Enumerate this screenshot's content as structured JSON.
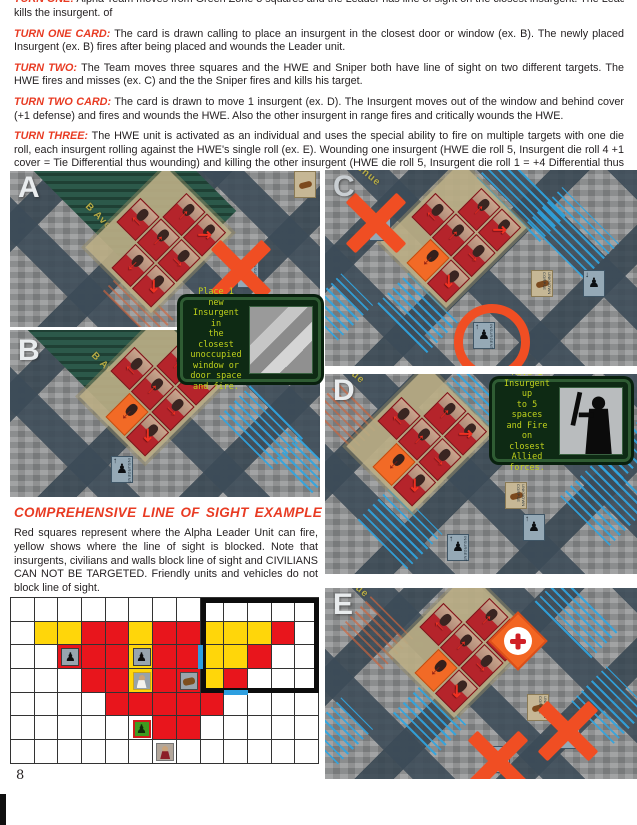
{
  "page": {
    "number": "8"
  },
  "intro": {
    "clipped_label": "TURN ONE:",
    "clipped_text": "Alpha Team moves from Green Zone 3 squares and the Leader has line of sight on the closest insurgent. The Leader fires and",
    "tail": "kills the insurgent. of"
  },
  "paragraphs": [
    {
      "label": "TURN ONE CARD:",
      "text": "The card is drawn calling to place an insurgent in the closest door or window (ex. B). The newly placed Insurgent (ex. B) fires after being placed and wounds the Leader unit."
    },
    {
      "label": "TURN TWO:",
      "text": "The Team moves three squares and the HWE and Sniper both have line of sight on two different targets. The HWE fires and misses (ex. C) and the the Sniper fires and kills his target."
    },
    {
      "label": "TURN TWO CARD:",
      "text": "The card is drawn to move 1 insurgent (ex. D). The Insurgent moves out of the window and behind cover (+1 defense) and fires and wounds the HWE. Also the other insurgent in range fires and critically wounds the HWE."
    },
    {
      "label": "TURN THREE:",
      "text": "The HWE unit is activated as an individual and uses the special ability to fire on multiple targets with one die roll, each insurgent rolling against the HWE's single roll (ex. E). Wounding one insurgent (HWE die roll 5, Insurgent die roll 4 +1 cover = Tie Differential thus wounding) and killing the other insurgent (HWE die roll 5, Insurgent die roll 1 = +4 Differential thus killing)."
    }
  ],
  "los": {
    "heading": "COMPREHENSIVE LINE OF SIGHT EXAMPLE",
    "text": "Red squares represent where the Alpha Leader Unit can fire, yellow shows where the line of sight is blocked. Note that insurgents, civilians and walls block line of sight and CIVILIANS CAN NOT BE TARGETED. Friendly units and vehicles do not block line of sight."
  },
  "panels": {
    "a": {
      "label": "A",
      "street": "B Ave"
    },
    "b": {
      "label": "B",
      "street": "B Ave"
    },
    "c": {
      "label": "C",
      "street": "enue"
    },
    "d": {
      "label": "D",
      "street": "ue"
    },
    "e": {
      "label": "E",
      "street": "ue"
    }
  },
  "action_cards": {
    "place": "Place 1 new\nInsurgent in\nthe closest\nunoccupied\nwindow or\ndoor space\nand fire.",
    "move": "Move 1\nInsurgent up\nto 5 spaces\nand Fire on\nclosest Allied\nforces."
  },
  "chips": {
    "insurgent": "INSURGENT",
    "corpse": "UNKNOWN CORPSE"
  },
  "grid": {
    "rows": [
      "WWWWWWWWWWWWW",
      "WYYRRYRRYYYRW",
      "WWRRRYRRYYRWW",
      "WWWRRYRRYRWWW",
      "WWWWRRRRRWWWW",
      "WWWWWWRRWWWWW",
      "WWWWWWWWWWWWW"
    ],
    "units": [
      {
        "row": 2,
        "col": 2,
        "type": "insurgent"
      },
      {
        "row": 2,
        "col": 5,
        "type": "insurgent"
      },
      {
        "row": 3,
        "col": 5,
        "type": "civilian"
      },
      {
        "row": 3,
        "col": 7,
        "type": "vehicle"
      },
      {
        "row": 5,
        "col": 5,
        "type": "leader"
      },
      {
        "row": 6,
        "col": 6,
        "type": "civilian2"
      }
    ],
    "legend": {
      "red_fire": "#e8151c",
      "yellow_blocked": "#ffd60a",
      "white_clear": "#ffffff"
    }
  },
  "colors": {
    "accent_red": "#e83b23",
    "map_street": "#3f4e5a",
    "card_red": "#b5242b",
    "card_orange": "#f26522",
    "action_green": "#0e2a14",
    "action_text": "#bfd11c",
    "hatch_blue": "#2fa5e1",
    "mark_orange": "#f04e23"
  }
}
